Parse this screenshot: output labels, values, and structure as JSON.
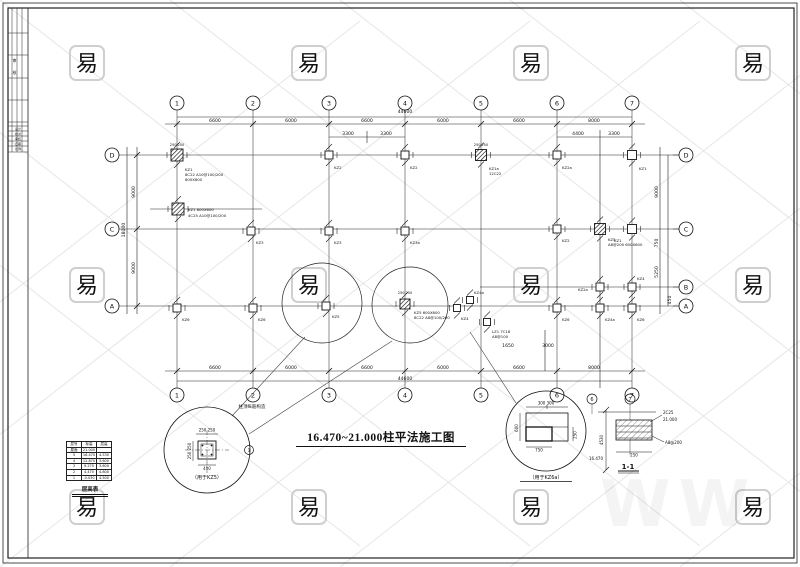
{
  "title": {
    "text": "16.470~21.000柱平法施工图"
  },
  "watermark": {
    "char": "易",
    "box_color": "#cfcfcf",
    "line_color": "#e0e0e0",
    "ghost": "WW"
  },
  "titleblock": {
    "c1": "审",
    "c2": "核",
    "rows": [
      "设计",
      "校对",
      "审核",
      "日期",
      "比例"
    ]
  },
  "grid": {
    "top_y": 103,
    "bottom_y": 395,
    "left_x": 112,
    "right_x": 686,
    "cols": [
      {
        "label": "1",
        "x": 177
      },
      {
        "label": "2",
        "x": 253
      },
      {
        "label": "3",
        "x": 329
      },
      {
        "label": "4",
        "x": 405
      },
      {
        "label": "5",
        "x": 481
      },
      {
        "label": "6",
        "x": 557
      },
      {
        "label": "7",
        "x": 632
      }
    ],
    "rows_left": [
      {
        "label": "D",
        "y": 155
      },
      {
        "label": "C",
        "y": 229
      },
      {
        "label": "A",
        "y": 306
      }
    ],
    "rows_right": [
      {
        "label": "D",
        "y": 155
      },
      {
        "label": "C",
        "y": 229
      },
      {
        "label": "B",
        "y": 287
      },
      {
        "label": "A",
        "y": 306
      }
    ]
  },
  "dim_texts": [
    {
      "t": "44600",
      "x": 405,
      "y": 113
    },
    {
      "t": "6600",
      "x": 215,
      "y": 122
    },
    {
      "t": "6000",
      "x": 291,
      "y": 122
    },
    {
      "t": "6600",
      "x": 367,
      "y": 122
    },
    {
      "t": "6000",
      "x": 443,
      "y": 122
    },
    {
      "t": "6600",
      "x": 519,
      "y": 122
    },
    {
      "t": "8000",
      "x": 594,
      "y": 122
    },
    {
      "t": "3300",
      "x": 348,
      "y": 135
    },
    {
      "t": "3300",
      "x": 386,
      "y": 135
    },
    {
      "t": "4400",
      "x": 578,
      "y": 135
    },
    {
      "t": "3300",
      "x": 614,
      "y": 135
    },
    {
      "t": "6600",
      "x": 215,
      "y": 369
    },
    {
      "t": "6000",
      "x": 291,
      "y": 369
    },
    {
      "t": "6600",
      "x": 367,
      "y": 369
    },
    {
      "t": "6000",
      "x": 443,
      "y": 369
    },
    {
      "t": "6600",
      "x": 519,
      "y": 369
    },
    {
      "t": "8000",
      "x": 594,
      "y": 369
    },
    {
      "t": "44600",
      "x": 405,
      "y": 380
    },
    {
      "t": "1650",
      "x": 508,
      "y": 347
    },
    {
      "t": "3000",
      "x": 548,
      "y": 347
    },
    {
      "t": "9000",
      "x": 135,
      "y": 192,
      "r": -90
    },
    {
      "t": "9000",
      "x": 135,
      "y": 268,
      "r": -90
    },
    {
      "t": "18000",
      "x": 125,
      "y": 230,
      "r": -90
    },
    {
      "t": "9000",
      "x": 658,
      "y": 192,
      "r": -90
    },
    {
      "t": "750",
      "x": 658,
      "y": 243,
      "r": -90
    },
    {
      "t": "5250",
      "x": 658,
      "y": 272,
      "r": -90
    },
    {
      "t": "450",
      "x": 671,
      "y": 300,
      "r": -90
    },
    {
      "t": "250 250",
      "x": 177,
      "y": 146,
      "f": 3.5
    },
    {
      "t": "250 250",
      "x": 481,
      "y": 146,
      "f": 3.5
    },
    {
      "t": "250 250",
      "x": 405,
      "y": 294,
      "f": 3.5
    }
  ],
  "lines": [
    [
      177,
      117,
      632,
      117
    ],
    [
      165,
      124,
      645,
      124
    ],
    [
      329,
      137,
      405,
      137
    ],
    [
      557,
      137,
      632,
      137
    ],
    [
      165,
      371,
      645,
      371
    ],
    [
      177,
      381,
      632,
      381
    ],
    [
      137,
      147,
      137,
      314
    ],
    [
      127,
      147,
      127,
      314
    ],
    [
      660,
      147,
      660,
      314
    ],
    [
      668,
      155,
      668,
      306
    ],
    [
      150,
      209,
      262,
      209
    ],
    [
      480,
      287,
      680,
      287
    ],
    [
      119,
      155,
      680,
      155
    ],
    [
      119,
      229,
      680,
      229
    ],
    [
      119,
      306,
      680,
      306
    ],
    [
      600,
      130,
      600,
      388
    ],
    [
      545,
      330,
      545,
      371
    ],
    [
      367,
      131,
      367,
      143
    ]
  ],
  "columns": [
    {
      "x": 177,
      "y": 155,
      "s": 12,
      "h": true,
      "t": [
        [
          "KZ1",
          8,
          16
        ],
        [
          "8C22 A10@100/200",
          8,
          21
        ],
        [
          "600X600",
          8,
          26
        ]
      ]
    },
    {
      "x": 329,
      "y": 155,
      "s": 8,
      "h": false,
      "t": [
        [
          "KZ2",
          5,
          14
        ]
      ]
    },
    {
      "x": 405,
      "y": 155,
      "s": 8,
      "h": false,
      "t": [
        [
          "KZ2",
          5,
          14
        ]
      ]
    },
    {
      "x": 481,
      "y": 155,
      "s": 11,
      "h": true,
      "t": [
        [
          "KZ1a",
          8,
          15
        ],
        [
          "12C22",
          8,
          20
        ]
      ]
    },
    {
      "x": 557,
      "y": 155,
      "s": 8,
      "h": false,
      "t": [
        [
          "KZ2a",
          5,
          14
        ]
      ]
    },
    {
      "x": 632,
      "y": 155,
      "s": 9,
      "h": false,
      "t": [
        [
          "KZ1",
          7,
          15
        ]
      ]
    },
    {
      "x": 178,
      "y": 209,
      "s": 12,
      "h": true,
      "t": [
        [
          "KZ1 600X600",
          10,
          2
        ],
        [
          "4C25 A10@100/200",
          10,
          8
        ]
      ]
    },
    {
      "x": 251,
      "y": 231,
      "s": 8,
      "h": false,
      "t": [
        [
          "KZ3",
          5,
          13
        ]
      ]
    },
    {
      "x": 329,
      "y": 231,
      "s": 8,
      "h": false,
      "t": [
        [
          "KZ3",
          5,
          13
        ]
      ]
    },
    {
      "x": 405,
      "y": 231,
      "s": 8,
      "h": false,
      "t": [
        [
          "KZ3a",
          5,
          13
        ]
      ]
    },
    {
      "x": 557,
      "y": 229,
      "s": 8,
      "h": false,
      "t": [
        [
          "KZ2",
          5,
          13
        ]
      ]
    },
    {
      "x": 600,
      "y": 229,
      "s": 11,
      "h": true,
      "t": [
        [
          "KZ5",
          8,
          12
        ],
        [
          "A8@200 600X600",
          8,
          17
        ]
      ]
    },
    {
      "x": 632,
      "y": 229,
      "s": 9,
      "h": false,
      "t": [
        [
          "KZ1",
          -18,
          13
        ]
      ]
    },
    {
      "x": 600,
      "y": 287,
      "s": 8,
      "h": false,
      "t": [
        [
          "KZ2a",
          -22,
          4
        ]
      ]
    },
    {
      "x": 632,
      "y": 287,
      "s": 8,
      "h": false,
      "t": [
        [
          "KZ4",
          5,
          -7
        ]
      ]
    },
    {
      "x": 177,
      "y": 308,
      "s": 8,
      "h": false,
      "t": [
        [
          "KZ6",
          5,
          13
        ]
      ]
    },
    {
      "x": 253,
      "y": 308,
      "s": 8,
      "h": false,
      "t": [
        [
          "KZ6",
          5,
          13
        ]
      ]
    },
    {
      "x": 326,
      "y": 306,
      "s": 8,
      "h": false,
      "t": [
        [
          "KZ5",
          6,
          12
        ]
      ]
    },
    {
      "x": 405,
      "y": 304,
      "s": 10,
      "h": true,
      "t": [
        [
          "KZ5 600X600",
          9,
          10
        ],
        [
          "8C22 A8@100/200",
          9,
          15
        ]
      ]
    },
    {
      "x": 457,
      "y": 308,
      "s": 7,
      "h": false,
      "t": [
        [
          "KZ4",
          4,
          12
        ]
      ]
    },
    {
      "x": 470,
      "y": 300,
      "s": 7,
      "h": false,
      "t": [
        [
          "KZ4a",
          4,
          -6
        ]
      ]
    },
    {
      "x": 487,
      "y": 322,
      "s": 7,
      "h": false,
      "t": [
        [
          "LZ1 7C18",
          5,
          11
        ],
        [
          "A8@100",
          5,
          16
        ]
      ]
    },
    {
      "x": 557,
      "y": 308,
      "s": 8,
      "h": false,
      "t": [
        [
          "KZ6",
          5,
          13
        ]
      ]
    },
    {
      "x": 600,
      "y": 308,
      "s": 8,
      "h": false,
      "t": [
        [
          "KZ4a",
          5,
          13
        ]
      ]
    },
    {
      "x": 632,
      "y": 308,
      "s": 8,
      "h": false,
      "t": [
        [
          "KZ6",
          5,
          13
        ]
      ]
    }
  ],
  "plan_circles": [
    {
      "cx": 322,
      "cy": 303,
      "r": 40
    },
    {
      "cx": 410,
      "cy": 305,
      "r": 38
    }
  ],
  "leaders": [
    [
      305,
      337,
      232,
      416
    ],
    [
      392,
      341,
      249,
      434
    ],
    [
      470,
      332,
      516,
      403
    ]
  ],
  "detail_a": {
    "caption": "（用于KZ5）",
    "note": "柱顶纵筋构造",
    "dim_top": "250 250",
    "dim_left": "250 250",
    "dim_bottom": "400",
    "tag": "1"
  },
  "detail_b": {
    "caption": "（用于KZ6a）",
    "dim_top": "300 300",
    "dim_left": "600",
    "dim_right": "250",
    "dim_bottom": "750"
  },
  "section": {
    "label": "1-1",
    "bubble_1": "6",
    "bubble_2": "7",
    "ann_1": "2C25",
    "ann_2": "A8@200",
    "elev_top": "21.000",
    "elev_left": "16.470",
    "dim": "4530",
    "dim_bottom": "250"
  },
  "floor_table": {
    "header": [
      "层号",
      "标高",
      "层高"
    ],
    "rows": [
      [
        "屋面",
        "21.000",
        ""
      ],
      [
        "5",
        "16.470",
        "4.530"
      ],
      [
        "4",
        "12.870",
        "3.600"
      ],
      [
        "3",
        "9.270",
        "3.600"
      ],
      [
        "2",
        "4.470",
        "4.800"
      ],
      [
        "1",
        "-0.030",
        "4.500"
      ]
    ],
    "caption": "层高表"
  }
}
